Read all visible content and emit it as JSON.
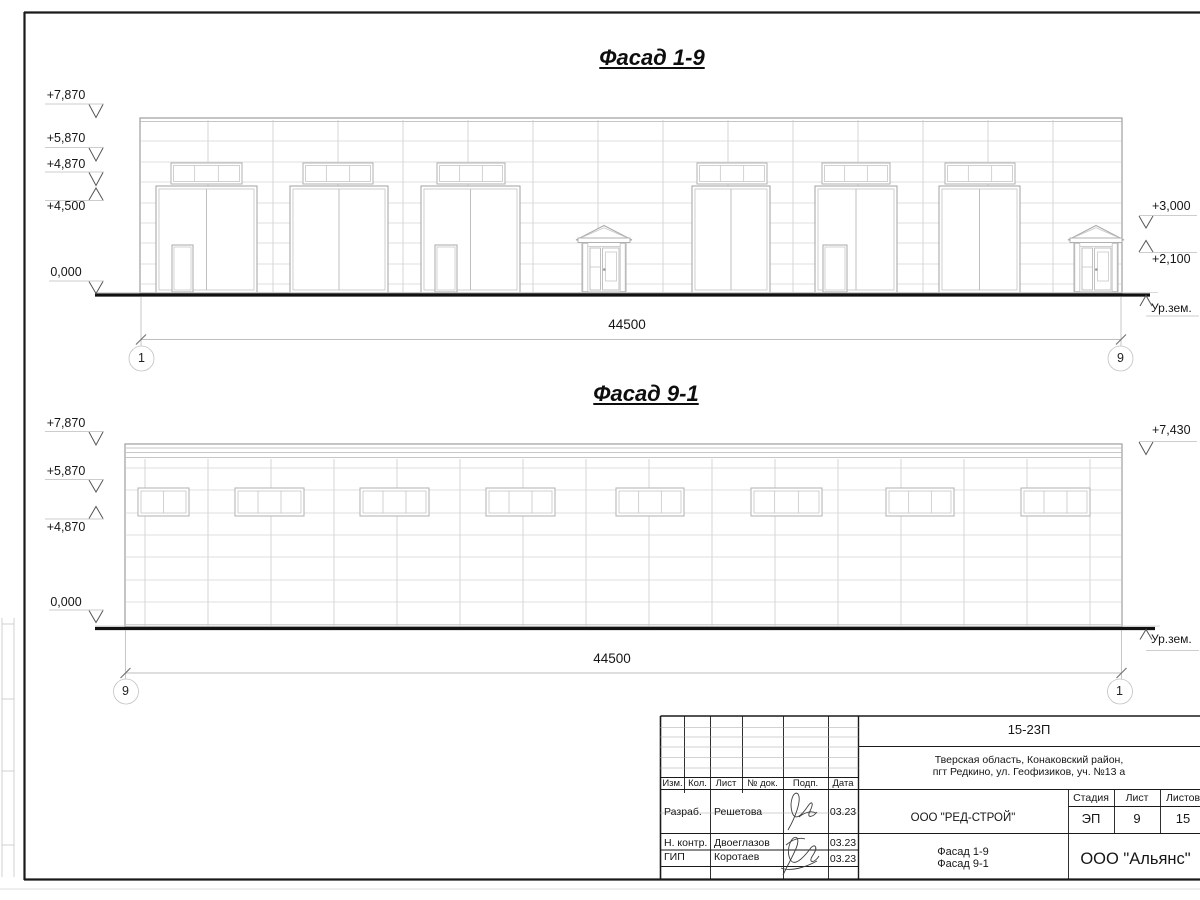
{
  "sheet": {
    "titles": {
      "f19": "Фасад 1-9",
      "f91": "Фасад 9-1"
    },
    "f19": {
      "marks_left": [
        "+7,870",
        "+5,870",
        "+4,870",
        "+4,500",
        "0,000"
      ],
      "marks_right": [
        "+3,000",
        "+2,100"
      ],
      "ground": "Ур.зем.",
      "dim": "44500",
      "axis_left": "1",
      "axis_right": "9"
    },
    "f91": {
      "marks_left": [
        "+7,870",
        "+5,870",
        "+4,870",
        "0,000"
      ],
      "marks_right": [
        "+7,430"
      ],
      "ground": "Ур.зем.",
      "dim": "44500",
      "axis_left": "9",
      "axis_right": "1"
    },
    "stamp": {
      "doc": "15-23П",
      "addr1": "Тверская область, Конаковский район,",
      "addr2": "пгт Редкино, ул. Геофизиков, уч. №13 а",
      "cols": [
        "Изм.",
        "Кол.",
        "Лист",
        "№ док.",
        "Подп.",
        "Дата"
      ],
      "stage_h": "Стадия",
      "sheet_h": "Лист",
      "sheets_h": "Листов",
      "stage": "ЭП",
      "sheet_no": "9",
      "sheets_total": "15",
      "client": "ООО \"РЕД-СТРОЙ\"",
      "obj1": "Фасад 1-9",
      "obj2": "Фасад 9-1",
      "company": "ООО \"Альянс\"",
      "rows": [
        {
          "role": "Разраб.",
          "name": "Решетова",
          "date": "03.23"
        },
        {
          "role": "Н. контр.",
          "name": "Двоеглазов",
          "date": "03.23"
        },
        {
          "role": "ГИП",
          "name": "Коротаев",
          "date": "03.23"
        }
      ]
    },
    "colors": {
      "ink": "#1a1a1a",
      "faint": "#cfcfcf",
      "mid": "#a9a9a9"
    }
  }
}
